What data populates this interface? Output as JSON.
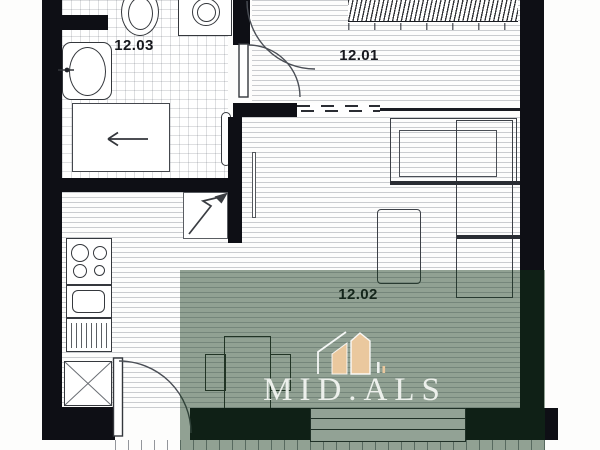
{
  "meta": {
    "type": "apartment-floor-plan"
  },
  "rooms": [
    {
      "id": "bathroom",
      "label": "12.03"
    },
    {
      "id": "bedroom",
      "label": "12.01"
    },
    {
      "id": "living-kitchen",
      "label": "12.02"
    }
  ],
  "watermark": {
    "brand": "MID.ALS",
    "logo": "house-logo"
  },
  "colors": {
    "wall": "#0e0f15",
    "watermark_green_rgba": "rgba(17,52,24,0.46)",
    "watermark_text": "#f2f5f1",
    "logo_tan": "#eac89e"
  },
  "fixtures": [
    "toilet",
    "washing-machine",
    "bathroom-sink",
    "shower",
    "towel-radiator",
    "stove",
    "kitchen-sink",
    "dishwasher",
    "fridge",
    "entrance-arrow",
    "wardrobe",
    "sofa",
    "desk",
    "dining-table",
    "chair",
    "bed-radiator-hatch",
    "bathroom-door",
    "bedroom-door",
    "balcony-door",
    "window",
    "balcony"
  ]
}
